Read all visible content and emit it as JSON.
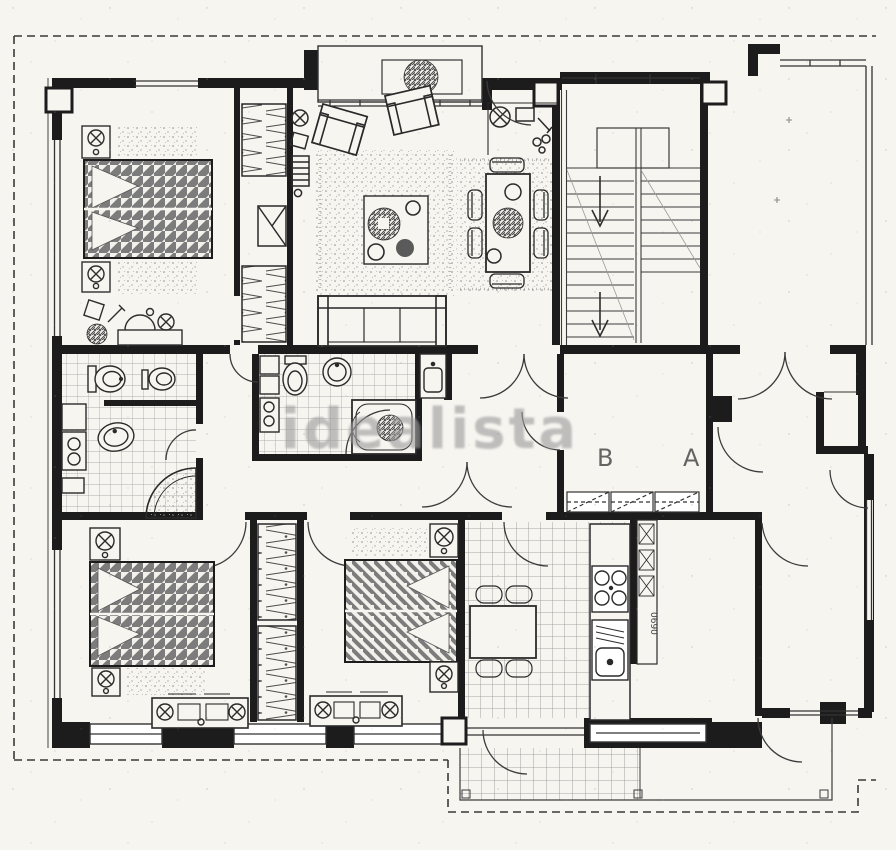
{
  "watermark": {
    "text": "idealista",
    "color": "#9b9b9b"
  },
  "entrance_labels": {
    "unit_b": "B",
    "unit_a": "A",
    "color": "#4a4a4a"
  },
  "kitchen": {
    "shaft_label": "0690"
  },
  "palette": {
    "paper": "#f7f5f0",
    "ink": "#1d1d1d",
    "line": "#333333",
    "hatch_gray": "#787878",
    "tile_gray": "#979797",
    "stipple_gray": "#8d8d8d"
  }
}
